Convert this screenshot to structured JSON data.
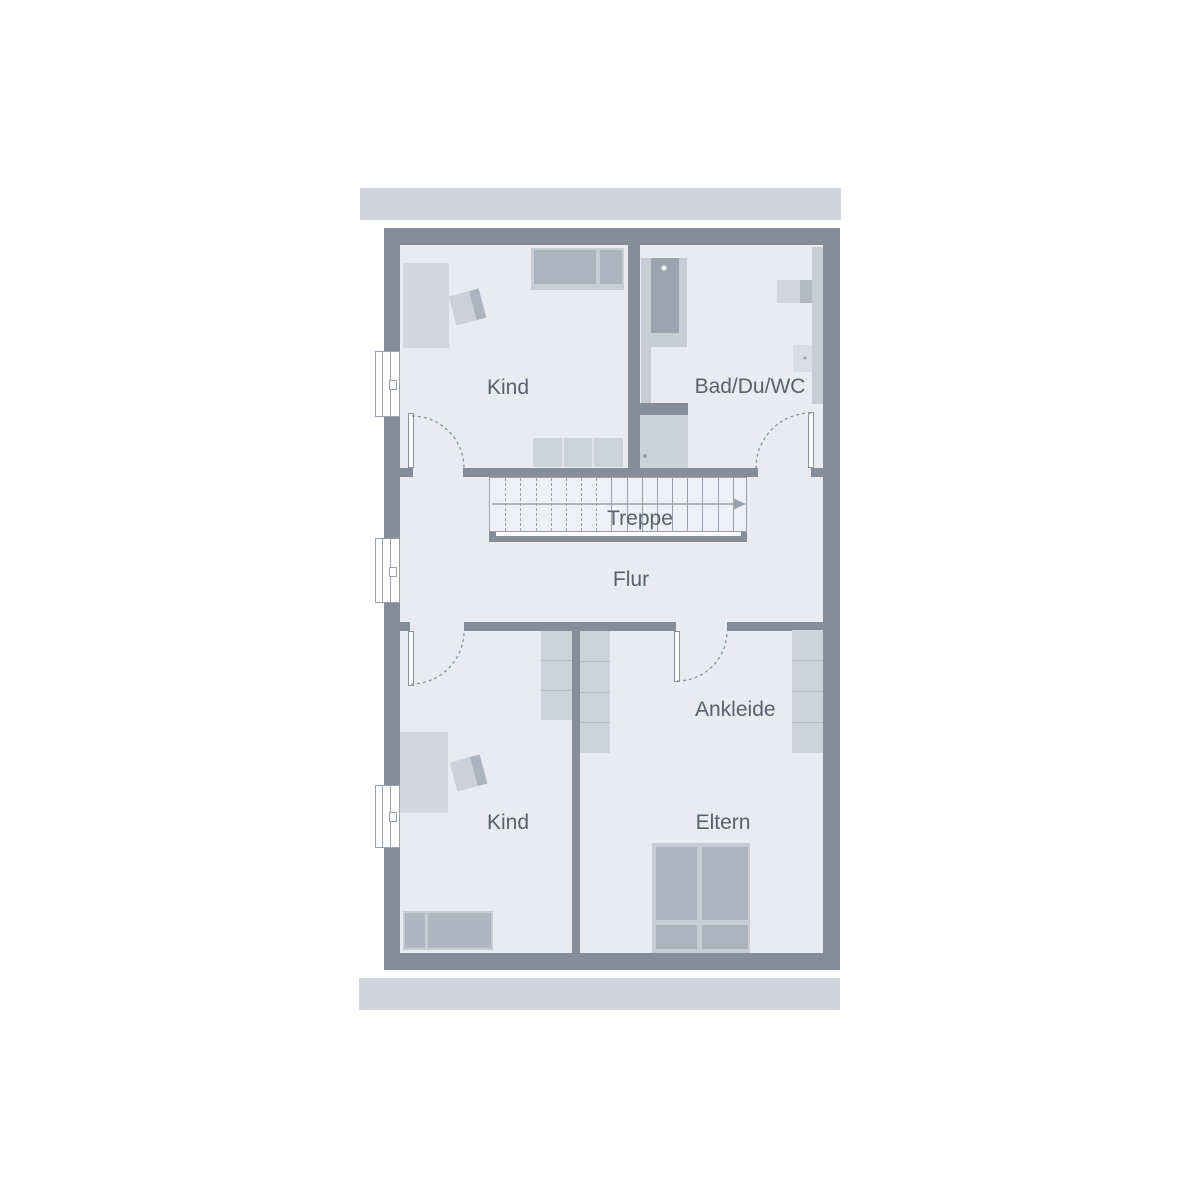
{
  "plan": {
    "type": "floor-plan",
    "labels": {
      "kind_top": "Kind",
      "bad": "Bad/Du/WC",
      "treppe": "Treppe",
      "flur": "Flur",
      "ankleide": "Ankleide",
      "kind_bottom": "Kind",
      "eltern": "Eltern"
    },
    "stairs": {
      "dashed_treads": 7,
      "solid_treads": 9,
      "direction": "right"
    }
  },
  "colors": {
    "wall": "#858d9b",
    "floor": "#e9ebf1",
    "band": "#d2d4db",
    "line": "#9aa1ad",
    "arc": "#8a91a0",
    "furn-light": "#d4d6de",
    "furn-mid": "#c8ccd5",
    "furn-dark": "#adb2bf",
    "cell": "#ced2da",
    "fixture": "#9da3b0",
    "txt": "#59606f"
  }
}
